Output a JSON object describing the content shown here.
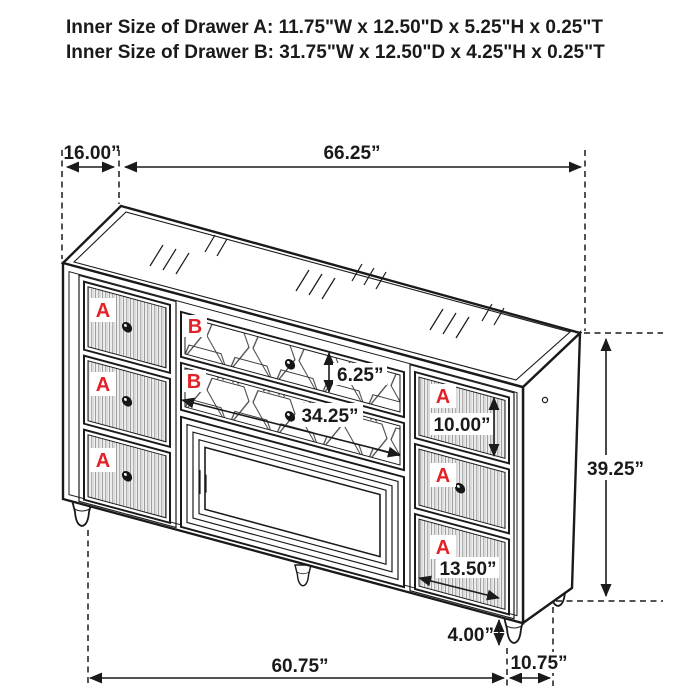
{
  "title": {
    "line1": "Inner Size of Drawer A: 11.75\"W x 12.50\"D x 5.25\"H x 0.25\"T",
    "line2": "Inner Size of Drawer B: 31.75\"W x 12.50\"D x 4.25\"H x 0.25\"T"
  },
  "drawer_labels": {
    "a": "A",
    "b": "B"
  },
  "dimensions": {
    "top_side": "16.00”",
    "top_width": "66.25”",
    "drawer_b_front_height": "6.25”",
    "drawer_b_front_width": "34.25”",
    "drawer_a_front_height": "10.00”",
    "overall_height": "39.25”",
    "drawer_a_front_width": "13.50”",
    "leg_height": "4.00”",
    "base_depth": "10.75”",
    "base_width": "60.75”"
  },
  "colors": {
    "accent_red": "#e32228",
    "line": "#1a1a1a"
  }
}
